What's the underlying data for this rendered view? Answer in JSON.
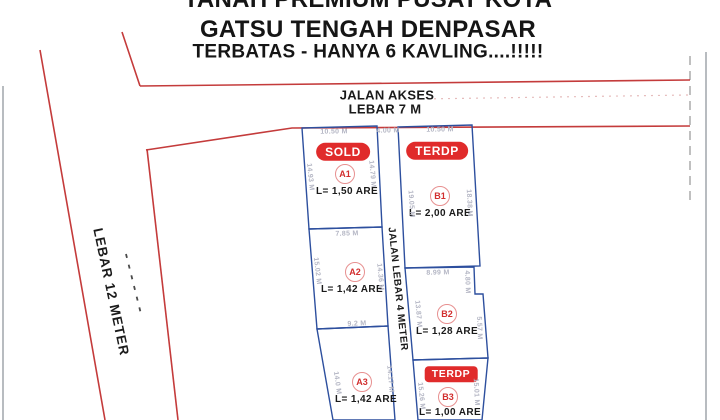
{
  "header": {
    "line1": "TANAH PREMIUM PUSAT KOTA",
    "line2": "GATSU TENGAH DENPASAR",
    "line3": "TERBATAS - HANYA 6 KAVLING....!!!!!"
  },
  "roads": {
    "access_line1": "JALAN AKSES",
    "access_line2": "LEBAR 7 M",
    "middle_label": "JALAN LEBAR 4 METER",
    "west_label": "LEBAR 12 METER"
  },
  "plots": [
    {
      "id": "A1",
      "badge": "SOLD",
      "area": "L= 1,50 ARE"
    },
    {
      "id": "A2",
      "badge": "",
      "area": "L= 1,42 ARE"
    },
    {
      "id": "A3",
      "badge": "",
      "area": "L= 1,42 ARE"
    },
    {
      "id": "B1",
      "badge": "TERDP",
      "area": "L= 2,00 ARE"
    },
    {
      "id": "B2",
      "badge": "",
      "area": "L= 1,28 ARE"
    },
    {
      "id": "B3",
      "badge": "TERDP",
      "area": "L= 1,00 ARE"
    }
  ],
  "measurements": [
    {
      "value": "10.50 M"
    },
    {
      "value": "4.00 M"
    },
    {
      "value": "10.50 M"
    },
    {
      "value": "14.93 M"
    },
    {
      "value": "14.79 M"
    },
    {
      "value": "7.85 M"
    },
    {
      "value": "15.02 M"
    },
    {
      "value": "14.36 M"
    },
    {
      "value": "9.2 M"
    },
    {
      "value": "14.0 M"
    },
    {
      "value": "14.17 M"
    },
    {
      "value": "19.05 M"
    },
    {
      "value": "18.38 M"
    },
    {
      "value": "8.99 M"
    },
    {
      "value": "13.87 M"
    },
    {
      "value": "4.80 M"
    },
    {
      "value": "5.57 M"
    },
    {
      "value": "15.26 M"
    },
    {
      "value": "15.01 M"
    }
  ],
  "colors": {
    "road_red": "#c43b3b",
    "plot_blue": "#2d4f9e",
    "badge_red": "#e02b2b",
    "dimension_gray": "#b4b6c4"
  }
}
